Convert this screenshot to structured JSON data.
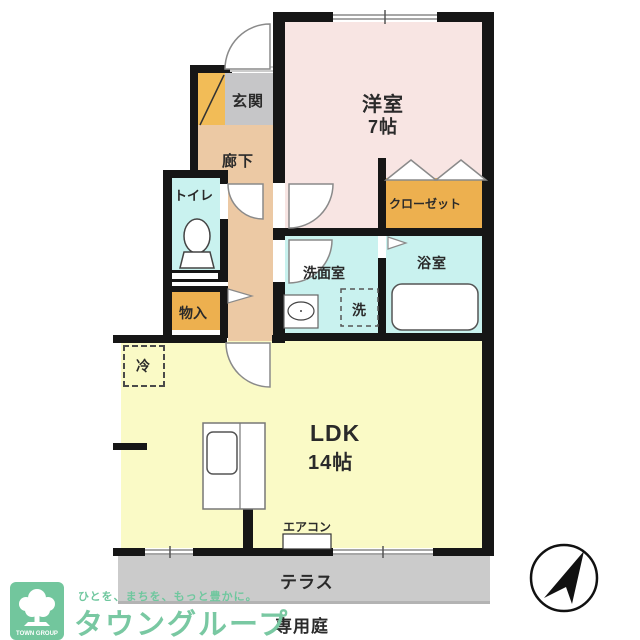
{
  "floorplan": {
    "rooms": {
      "entrance": {
        "label": "玄関"
      },
      "hallway": {
        "label": "廊下"
      },
      "western_room": {
        "label": "洋室",
        "size": "7帖"
      },
      "closet": {
        "label": "クローゼット"
      },
      "toilet": {
        "label": "トイレ"
      },
      "washroom": {
        "label": "洗面室"
      },
      "washer": {
        "label": "洗"
      },
      "bathroom": {
        "label": "浴室"
      },
      "storage": {
        "label": "物入"
      },
      "fridge": {
        "label": "冷"
      },
      "ldk": {
        "label": "LDK",
        "size": "14帖"
      },
      "aircon": {
        "label": "エアコン"
      },
      "terrace": {
        "label": "テラス"
      },
      "private_garden": {
        "label": "専用庭"
      }
    },
    "colors": {
      "wall": "#161616",
      "western_room_fill": "#f8e5e3",
      "hallway_fill": "#ecc9a4",
      "entrance_fill": "#c6c6c8",
      "shoebox_fill": "#f2bc57",
      "closet_fill": "#edb04f",
      "wet_room_fill": "#c9f2ef",
      "ldk_fill": "#fafac6",
      "terrace_fill": "#cbcbcb"
    }
  },
  "branding": {
    "tagline": "ひとを、まちを、もっと豊かに。",
    "company": "タウングループ",
    "logo_text": "TOWN GROUP",
    "green": "#79c8a2"
  }
}
